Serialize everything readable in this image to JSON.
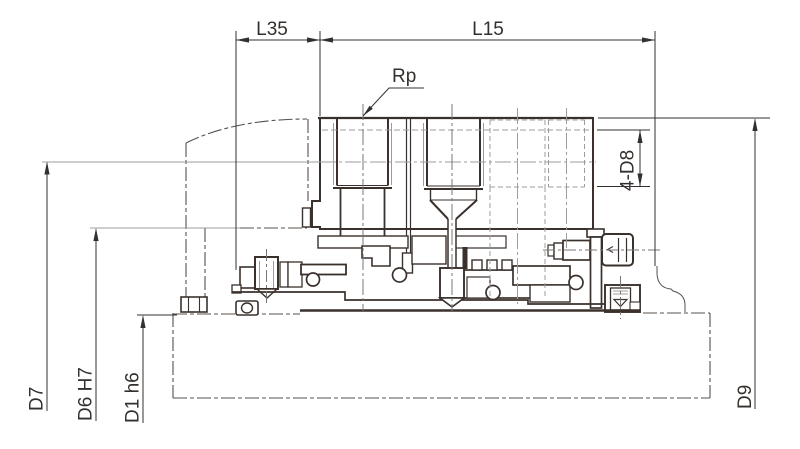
{
  "drawing": {
    "title": "mechanical-assembly-section-drawing",
    "labels": {
      "l35": "L35",
      "l15": "L15",
      "rp": "Rp",
      "d8_holes": "4-D8",
      "d7": "D7",
      "d6": "D6 H7",
      "d1": "D1 h6",
      "d9": "D9"
    },
    "colors": {
      "outline": "#3a312c",
      "thin_line": "#9c9c9c",
      "centerline": "#777777",
      "phantom": "#57504b",
      "text": "#33302d",
      "background": "#ffffff"
    }
  }
}
